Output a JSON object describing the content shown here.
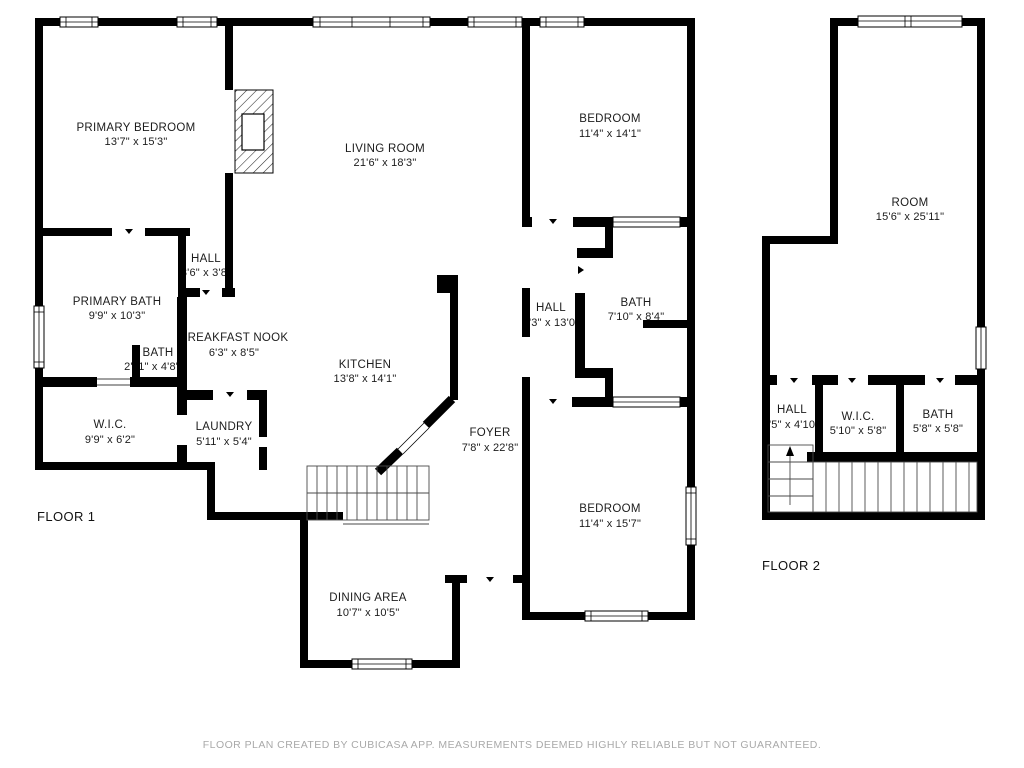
{
  "meta": {
    "app": "CubiCasa floor plan",
    "colors": {
      "wall": "#000000",
      "label": "#1c1c1c",
      "disclaimer": "#a9a9a9",
      "background": "#ffffff"
    }
  },
  "floor1": {
    "label": "FLOOR 1",
    "rooms": [
      {
        "name": "PRIMARY BEDROOM",
        "dims": "13'7\" x 15'3\""
      },
      {
        "name": "LIVING ROOM",
        "dims": "21'6\" x 18'3\""
      },
      {
        "name": "BEDROOM",
        "dims": "11'4\" x 14'1\""
      },
      {
        "name": "HALL",
        "dims": "3'6\" x 3'8\""
      },
      {
        "name": "PRIMARY BATH",
        "dims": "9'9\" x 10'3\""
      },
      {
        "name": "HALL",
        "dims": "3'3\" x 13'0\""
      },
      {
        "name": "BATH",
        "dims": "7'10\" x 8'4\""
      },
      {
        "name": "BREAKFAST NOOK",
        "dims": "6'3\" x 8'5\""
      },
      {
        "name": "BATH",
        "dims": "2'11\" x 4'8\""
      },
      {
        "name": "KITCHEN",
        "dims": "13'8\" x 14'1\""
      },
      {
        "name": "W.I.C.",
        "dims": "9'9\" x 6'2\""
      },
      {
        "name": "LAUNDRY",
        "dims": "5'11\" x 5'4\""
      },
      {
        "name": "FOYER",
        "dims": "7'8\" x 22'8\""
      },
      {
        "name": "BEDROOM",
        "dims": "11'4\" x 15'7\""
      },
      {
        "name": "DINING AREA",
        "dims": "10'7\" x 10'5\""
      }
    ]
  },
  "floor2": {
    "label": "FLOOR 2",
    "rooms": [
      {
        "name": "ROOM",
        "dims": "15'6\" x 25'11\""
      },
      {
        "name": "HALL",
        "dims": "3'5\" x 4'10\""
      },
      {
        "name": "W.I.C.",
        "dims": "5'10\" x 5'8\""
      },
      {
        "name": "BATH",
        "dims": "5'8\" x 5'8\""
      }
    ]
  },
  "disclaimer": "FLOOR PLAN CREATED BY CUBICASA APP. MEASUREMENTS DEEMED HIGHLY RELIABLE BUT NOT GUARANTEED."
}
